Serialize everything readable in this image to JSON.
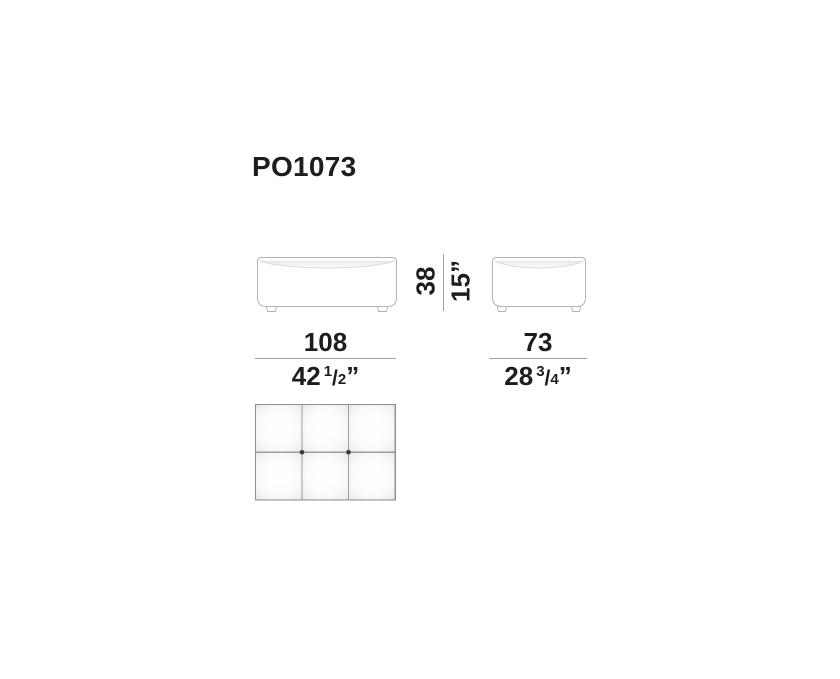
{
  "product": {
    "code": "PO1073"
  },
  "dimensions": {
    "width": {
      "cm": "108",
      "inch_whole": "42",
      "frac_numerator": "1",
      "frac_separator": "/",
      "frac_denominator": "2",
      "inch_mark": "”"
    },
    "depth": {
      "cm": "73",
      "inch_whole": "28",
      "frac_numerator": "3",
      "frac_separator": "/",
      "frac_denominator": "4",
      "inch_mark": "”"
    },
    "height": {
      "cm": "38",
      "inch": "15”"
    }
  },
  "colors": {
    "text": "#1d1d1b",
    "drawing_outline": "#b3b3b3",
    "dimension_line": "#a0a0a0",
    "top_view_grid": "#8f8f8f",
    "tuft_button": "#3a3a3a",
    "background": "#ffffff"
  }
}
